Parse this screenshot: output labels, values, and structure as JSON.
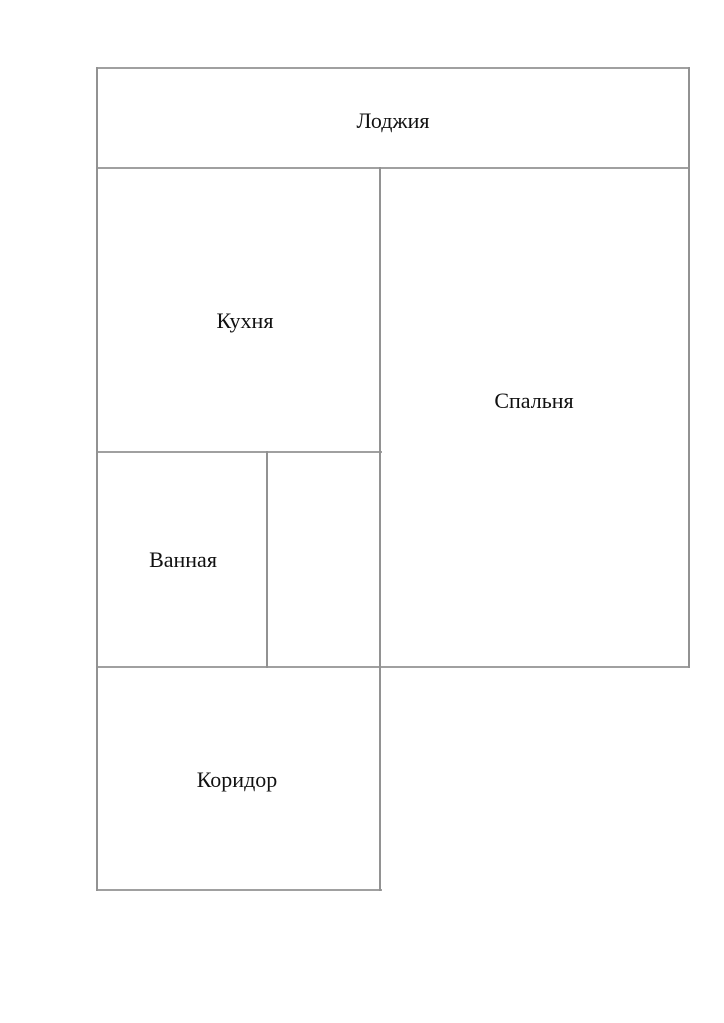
{
  "diagram": {
    "type": "floor-plan",
    "background_color": "#ffffff",
    "wall_color": "#a0a0a0",
    "text_color": "#111111",
    "rooms": {
      "loggia": {
        "label": "Лоджия"
      },
      "kitchen": {
        "label": "Кухня"
      },
      "bedroom": {
        "label": "Спальня"
      },
      "bathroom": {
        "label": "Ванная"
      },
      "storage": {
        "label": ""
      },
      "corridor": {
        "label": "Коридор"
      }
    }
  }
}
